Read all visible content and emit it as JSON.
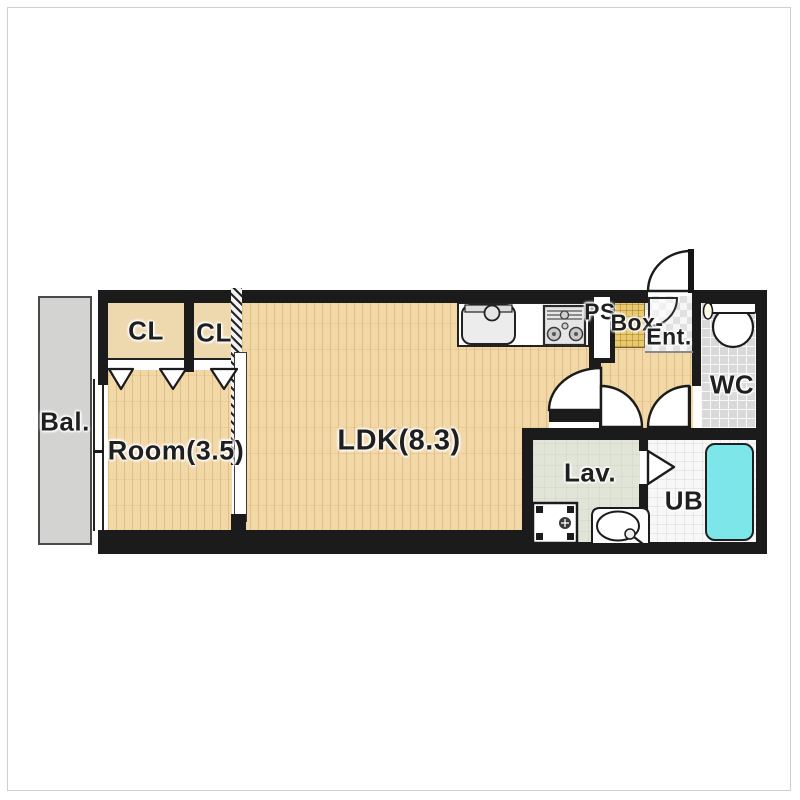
{
  "rooms": {
    "balcony": {
      "label": "Bal."
    },
    "closet_left": {
      "label": "CL"
    },
    "closet_right": {
      "label": "CL"
    },
    "room": {
      "label": "Room(3.5)"
    },
    "ldk": {
      "label": "LDK(8.3)"
    },
    "pipe_space": {
      "label": "PS"
    },
    "shoe_box": {
      "label": "Box-"
    },
    "entrance": {
      "label": "Ent."
    },
    "wc": {
      "label": "WC"
    },
    "lavatory": {
      "label": "Lav."
    },
    "unit_bath": {
      "label": "UB"
    }
  },
  "colors": {
    "wall": "#1b1b1b",
    "wood": "#f2d8a7",
    "closet": "#eed8ae",
    "balcony": "#d3d3d1",
    "lav": "#e0e5d8",
    "wcfloor": "#d9d9d9",
    "ubfloor": "#f7f7f7",
    "tub": "#7ce6e9",
    "box": "#e8c96d"
  }
}
